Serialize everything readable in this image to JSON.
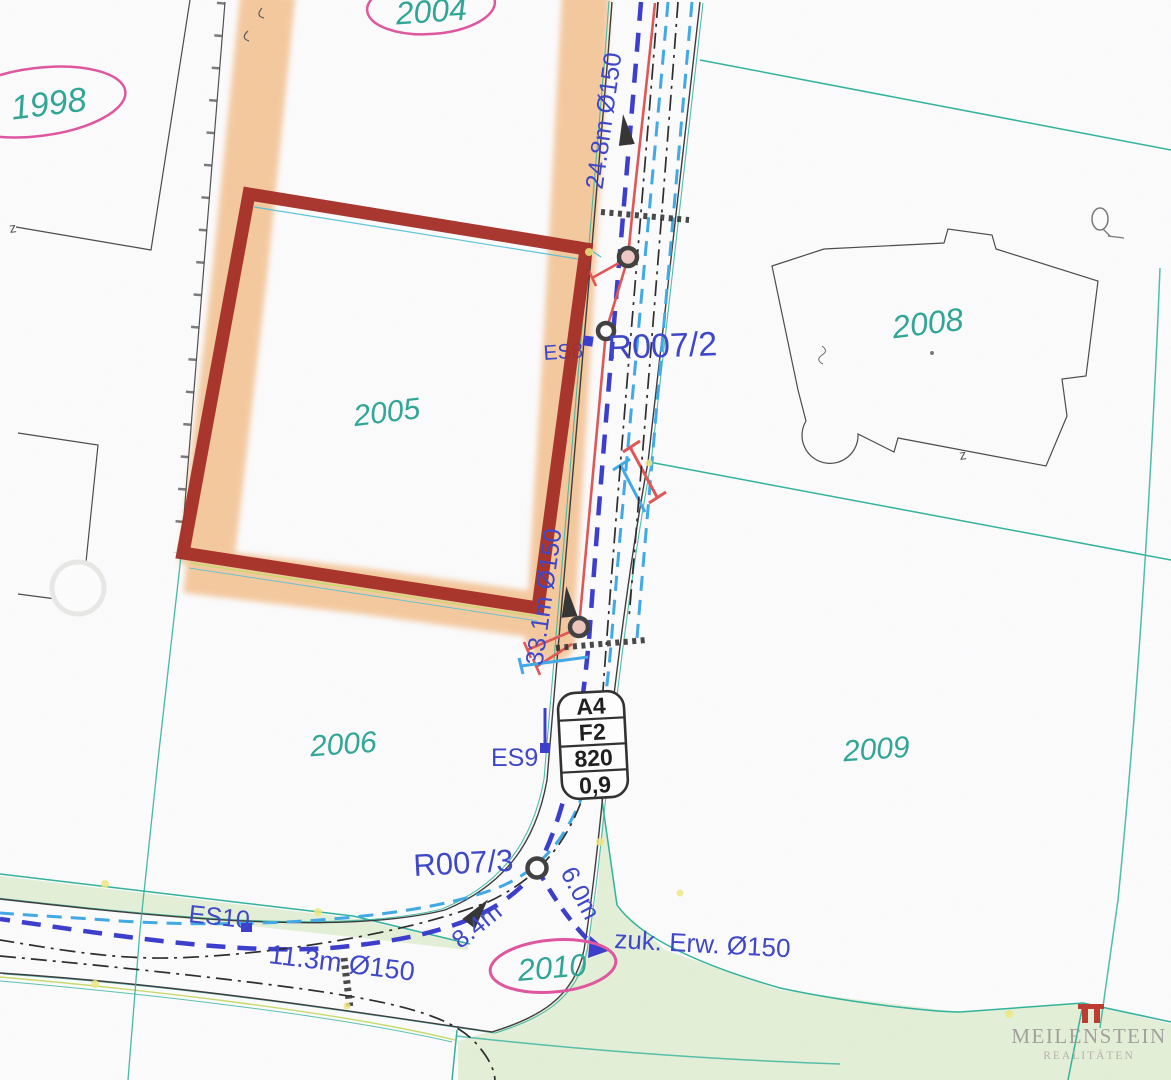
{
  "map": {
    "title": "Cadastral utility plan with highlighted parcel 2005",
    "parcel_labels": {
      "p1998": "1998",
      "p2004": "2004",
      "p2005": "2005",
      "p2006": "2006",
      "p2008": "2008",
      "p2009": "2009",
      "p2010": "2010"
    },
    "utility_labels": {
      "r007_2": "R007/2",
      "r007_3": "R007/3",
      "es8": "ES8",
      "es9": "ES9",
      "es10": "ES10"
    },
    "measurements": {
      "m24": "24.8m Ø150",
      "m33": "33.1m Ø150",
      "m11": "11.3m Ø150",
      "m8": "8.4m",
      "m6": "6.0m",
      "zuk": "zuk. Erw. Ø150"
    },
    "survey_marks": {
      "z": "z"
    },
    "infobox": {
      "row1": "A4",
      "row2": "F2",
      "row3": "820",
      "row4": "0,9"
    },
    "watermark": {
      "name": "MEILENSTEIN",
      "subtitle": "REALITÄTEN"
    },
    "colors": {
      "highlight_border": "#A42D24",
      "highlight_fill": "#F3BC86",
      "parcel_number": "#2EA695",
      "label_blue": "#3C45C8",
      "boundary_teal": "#2FB39B",
      "ellipse_pink": "#E0559E",
      "water_line_red": "#E05555",
      "sewer_line_blue": "#3A3CCC",
      "drain_line_cyan": "#3FA9E6",
      "grass_green": "#E4EFD8",
      "road_edge_dark": "#3B3B3B"
    }
  }
}
